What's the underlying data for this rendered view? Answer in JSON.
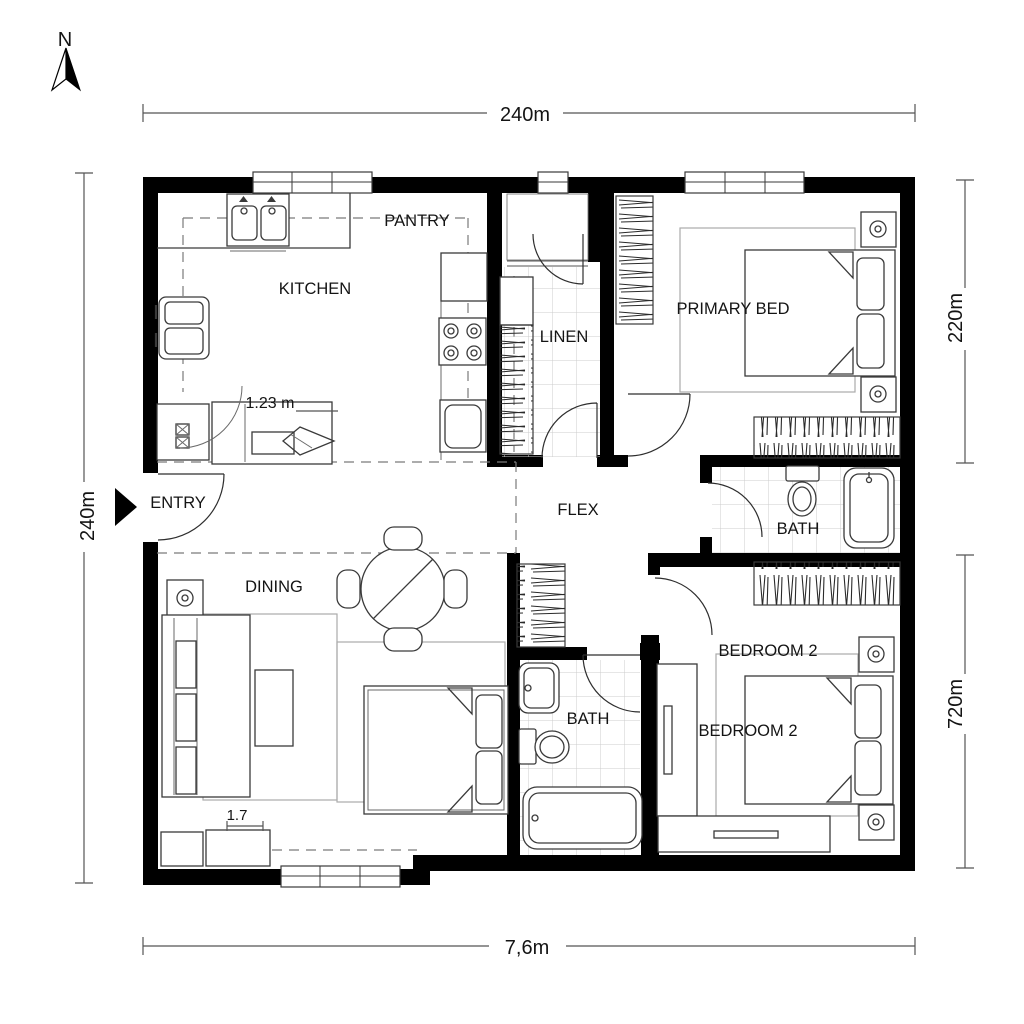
{
  "page": {
    "title": "Floor Plan",
    "background": "#ffffff"
  },
  "colors": {
    "walls": "#000000",
    "furniture_lines": "#3a3a3a",
    "dashed_lines": "#7a7a7a",
    "tile_grid": "#cccccc",
    "dimension_lines": "#555555",
    "text": "#141414"
  },
  "compass": {
    "north_label": "N"
  },
  "dimensions": {
    "top_width": "240m",
    "left_height": "240m",
    "right_upper_height": "220m",
    "right_lower_height": "720m",
    "bottom_width": "7,6m"
  },
  "rooms": {
    "kitchen": {
      "label": "KITCHEN"
    },
    "pantry": {
      "label": "PANTRY"
    },
    "linen": {
      "label": "LINEN"
    },
    "primary_bedroom": {
      "label": "PRIMARY BED"
    },
    "entry": {
      "label": "ENTRY"
    },
    "flex": {
      "label": "FLEX"
    },
    "bath_upper": {
      "label": "BATH"
    },
    "dining": {
      "label": "DINING"
    },
    "bath_lower": {
      "label": "BATH"
    },
    "bedroom2_upper": {
      "label": "BEDROOM 2"
    },
    "bedroom2": {
      "label": "BEDROOM 2"
    }
  },
  "annotations": {
    "kitchen_clearance": "1.23 m",
    "console_width": "1.7"
  }
}
